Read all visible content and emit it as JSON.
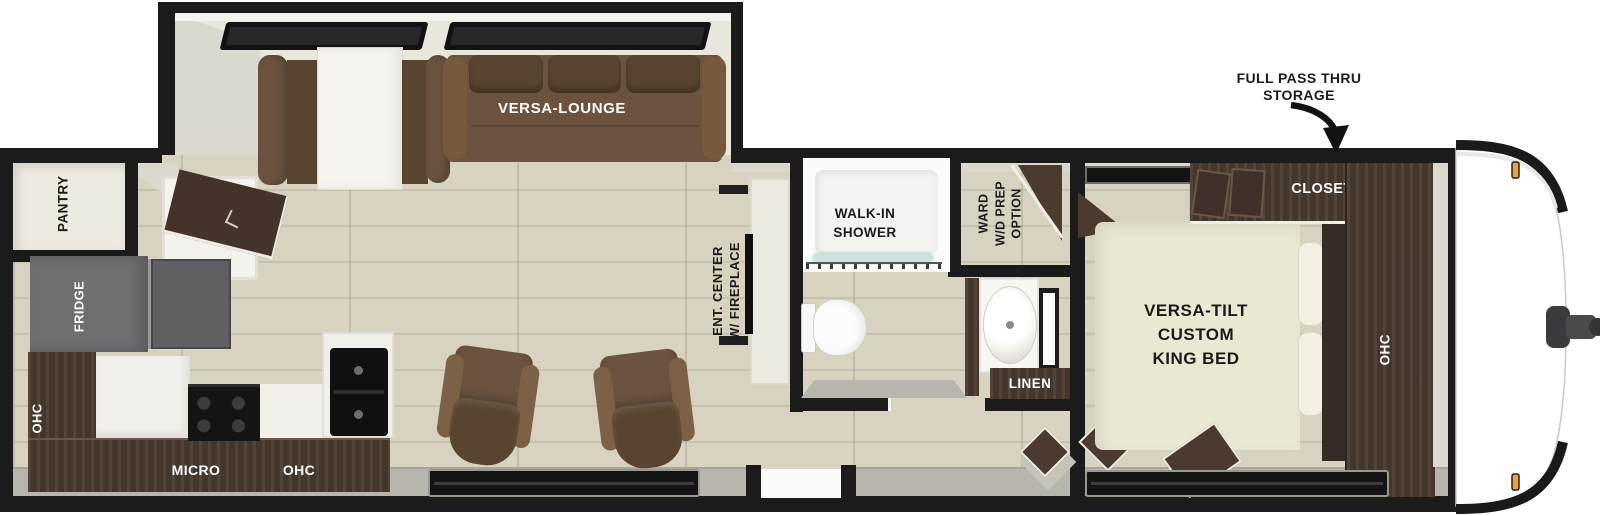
{
  "colors": {
    "wall": "#1b1b1b",
    "cream": "#e9e6dc",
    "creamDark": "#dbd8cd",
    "floor": "#d8d3c0",
    "floorLine": "#c7c2ae",
    "sill": "#b8b5ad",
    "wood": "#4a3a2f",
    "woodDark": "#362c25",
    "sofa": "#6b5340",
    "sofaDark": "#59452f",
    "bed": "#eae7d3",
    "pillow": "#f4f1e4",
    "fridge": "#6f6f73",
    "fridgeDoor": "#5f5f64",
    "counter": "#f1efe9",
    "appliance": "#141414",
    "glass": "#a9cec7",
    "marker": "#e8a33d",
    "labelLight": "#ffffff",
    "labelDark": "#1b1b1b"
  },
  "labels": {
    "callout_line1": "FULL PASS THRU",
    "callout_line2": "STORAGE",
    "versa_lounge": "VERSA-LOUNGE",
    "pantry": "PANTRY",
    "fridge": "FRIDGE",
    "ohc_left": "OHC",
    "micro": "MICRO",
    "ohc_kitchen": "OHC",
    "ent_center_line1": "ENT. CENTER",
    "ent_center_line2": "W/ FIREPLACE",
    "shower_line1": "WALK-IN",
    "shower_line2": "SHOWER",
    "ward_line1": "WARD",
    "ward_line2": "W/D PREP",
    "ward_line3": "OPTION",
    "linen": "LINEN",
    "closet": "CLOSET",
    "bed_line1": "VERSA-TILT",
    "bed_line2": "CUSTOM",
    "bed_line3": "KING BED",
    "ohc_bedroom": "OHC"
  }
}
